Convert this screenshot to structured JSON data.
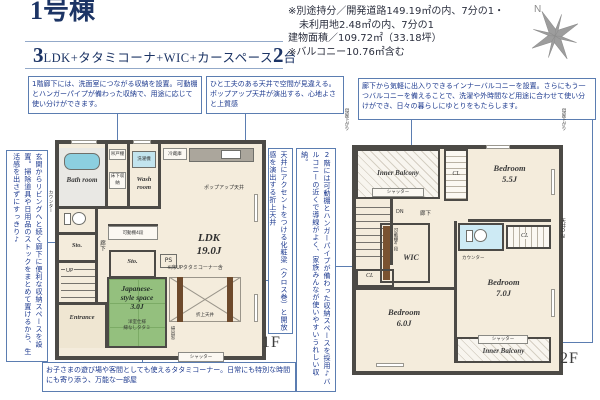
{
  "header": {
    "title": "1号棟",
    "plan": {
      "num1": "3",
      "mid": "LDK+タタミコーナ+WIC+カースペース",
      "num2": "2",
      "suffix": "台"
    }
  },
  "info": {
    "line1": "※別途持分／開発道路149.19㎡の内、7分の1・",
    "line2": "未利用地2.48㎡の内、7分の1",
    "line3": "建物面積／109.72㎡（33.18坪）",
    "line4": "※バルコニー10.76㎡含む"
  },
  "compass": {
    "n": "N"
  },
  "callouts": {
    "storage1f": "1階廊下には、洗面室につながる収納を設置。可動棚とハンガーパイプが備わった収納で、用途に応じて使い分けができます。",
    "ceiling": "ひと工夫のある天井で空間が見違える。ポップアップ天井が演出する、心地よさと上質感",
    "balcony": "廊下から気軽に出入りできるインナーバルコニーを設置。さらにもう一つバルコニーを備えることで、洗濯や外時間など用途に合わせて使い分けができ、日々の暮らしにゆとりをもたらします。",
    "entrance_storage": "玄関からリビングへと続く廊下に便利な収納スペースを設置。掃除道具や日用品のストックをまとめて置けるから、生活感を出さずにすっきり♪",
    "beam": "天井にアクセントをつける化粧梁（クロス巻）と開放感を演出する折上天井",
    "storage2f": "2階には可動棚とハンガーパイプが備わった収納スペースを採用♪バルコニーの近くで導線がよく、家族みんなが使いやすいうれしい収納。",
    "tatami": "お子さまの遊び場や客間としても使えるタタミコーナー。日常にも特別な時間にも寄り添う、万能な一部屋"
  },
  "floor1": {
    "label": "1F",
    "bath": "Bath room",
    "hang_cab": "吊戸棚",
    "underfloor": "床下収納",
    "washer": "洗濯機",
    "wash": "Wash room",
    "fridge": "冷蔵庫",
    "popup": "ポップアップ天井",
    "ldk": "LDK",
    "ldk_size": "19.0J",
    "ldk_note": "※床UPタタミコーナー含",
    "coffered": "折上天井",
    "jp_l1": "Japanese-",
    "jp_l2": "style space",
    "jp_l3": "3.0J",
    "jp_n1": "洋室仕様",
    "jp_n2": "縁なしタタミ",
    "sto1": "Sto.",
    "sto2": "Sto.",
    "up": "UP",
    "hall": "廊下",
    "entrance": "Entrance",
    "shelf": "可動棚4段",
    "ps": "PS",
    "shutter": "シャッター",
    "counter": "カウンター",
    "window": "掃出窓"
  },
  "floor2": {
    "label": "2F",
    "balc_tl": "Inner Balcony",
    "balc_br": "Inner Balcony",
    "shut1": "シャッター",
    "shut2": "シャッター",
    "bed1": "Bedroom",
    "bed1_size": "5.5J",
    "bed2": "Bedroom",
    "bed2_size": "6.0J",
    "bed3": "Bedroom",
    "bed3_size": "7.0J",
    "wic": "WIC",
    "shelf": "可動棚4段",
    "cl_top": "CL",
    "cl_right": "CL",
    "cl_left": "CL",
    "dn": "DN",
    "hall": "廊下",
    "counter": "カウンター",
    "ceiling_dn": "天井DN",
    "moya_left": "母屋下がり",
    "moya_right": "母屋下がり"
  }
}
